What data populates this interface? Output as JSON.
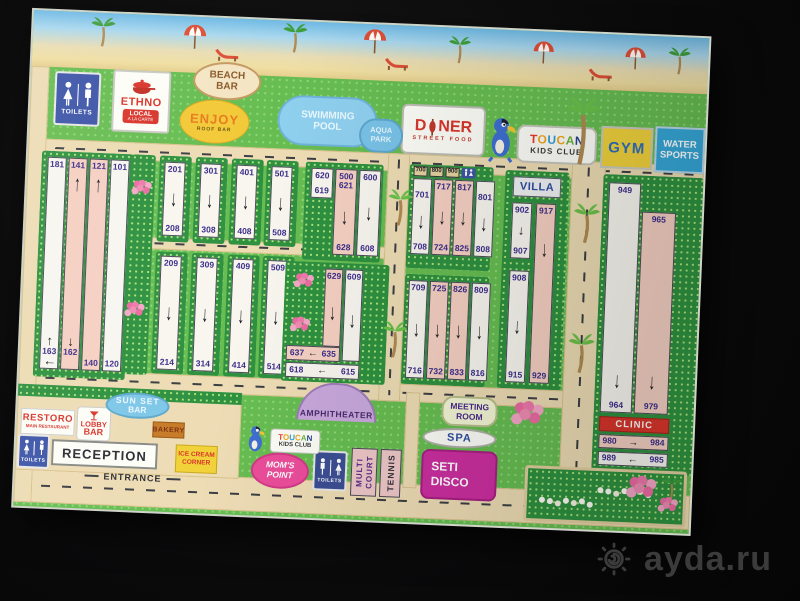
{
  "watermark": {
    "site": "ayda.ru"
  },
  "icons": {
    "down": "↓",
    "up": "↑",
    "left": "←",
    "right": "→"
  },
  "top": {
    "toilets": "TOILETS",
    "ethno": {
      "title": "ETHNO",
      "line1": "LOCAL",
      "line2": "A LA CARTE"
    },
    "beach_bar": {
      "line1": "BEACH",
      "line2": "BAR"
    },
    "enjoy": {
      "title": "ENJOY",
      "sub": "ROOF BAR"
    },
    "pool": {
      "line1": "SWIMMING",
      "line2": "POOL"
    },
    "aqua": {
      "line1": "AQUA",
      "line2": "PARK"
    },
    "doner": {
      "left": "D",
      "right": "NER",
      "sub": "STREET FOOD"
    },
    "toucan": {
      "letters": [
        "T",
        "O",
        "U",
        "C",
        "A",
        "N"
      ],
      "sub": "KIDS CLUB"
    },
    "gym": "GYM",
    "water_sports": {
      "line1": "WATER",
      "line2": "SPORTS"
    }
  },
  "rooms": {
    "b100": {
      "cols": [
        {
          "top": "181",
          "bottom": "163"
        },
        {
          "top": "141",
          "bottom": "162"
        },
        {
          "top": "121",
          "bottom": "140"
        },
        {
          "top": "101",
          "bottom": "120"
        }
      ]
    },
    "b200t": {
      "top": "201",
      "bottom": "208"
    },
    "b200b": {
      "top": "209",
      "bottom": "214"
    },
    "b300t": {
      "top": "301",
      "bottom": "308"
    },
    "b300b": {
      "top": "309",
      "bottom": "314"
    },
    "b400t": {
      "top": "401",
      "bottom": "408"
    },
    "b400b": {
      "top": "409",
      "bottom": "414"
    },
    "b500t": {
      "top": "501",
      "bottom": "508"
    },
    "b500b": {
      "top": "509",
      "bottom": "514"
    },
    "b600": {
      "mini_top": "620",
      "mini_bottom": "619",
      "pink_label": "500",
      "pink_top": "621",
      "pink_bottom": "628",
      "white_top": "600",
      "white_bottom": "608"
    },
    "b600L": {
      "pink_top": "629",
      "pink_corner": "635",
      "pink_end": "637",
      "white_top": "609",
      "white_corner": "615",
      "white_end": "618"
    },
    "b700": {
      "signs": [
        "700",
        "800",
        "900"
      ],
      "h1": "717",
      "h2": "817",
      "cols": [
        {
          "top": "701",
          "bottom": "708"
        },
        {
          "bottom": "724"
        },
        {
          "bottom": "825"
        },
        {
          "top": "801",
          "bottom": "808"
        }
      ]
    },
    "b700b": {
      "cols": [
        {
          "top": "709",
          "bottom": "716"
        },
        {
          "top": "725",
          "bottom": "732"
        },
        {
          "top": "826",
          "bottom": "833"
        },
        {
          "top": "809",
          "bottom": "816"
        }
      ]
    },
    "villa": {
      "label": "VILLA",
      "w1_top": "902",
      "w1_bottom": "907",
      "w2_top": "908",
      "w2_bottom": "915",
      "p_top": "917",
      "p_bottom": "929"
    },
    "b900": {
      "white_top": "949",
      "white_bottom": "964",
      "pink_top": "965",
      "pink_bottom": "979",
      "row1_left": "980",
      "row1_right": "984",
      "row2_left": "989",
      "row2_right": "985"
    }
  },
  "bottom": {
    "restoro": {
      "title": "RESTORO",
      "sub": "MAIN RESTAURANT"
    },
    "lobby": {
      "line1": "LOBBY",
      "line2": "BAR"
    },
    "sunset": {
      "line1": "SUN SET",
      "line2": "BAR"
    },
    "bakery": "BAKERY",
    "toilets": "TOILETS",
    "reception": "RECEPTION",
    "entrance": "ENTRANCE",
    "icecream": {
      "line1": "ICE CREAM",
      "line2": "CORNER"
    },
    "amphitheater": "AMPHITHEATER",
    "moms": {
      "line1": "MOM'S",
      "line2": "POINT"
    },
    "toilets2": "TOILETS",
    "multicourt": {
      "line1": "MULTI",
      "line2": "COURT"
    },
    "tennis": "TENNIS",
    "meeting": {
      "line1": "MEETING",
      "line2": "ROOM"
    },
    "spa": "SPA",
    "disco": {
      "line1": "SETI",
      "line2": "DISCO"
    },
    "clinic": "CLINIC"
  }
}
